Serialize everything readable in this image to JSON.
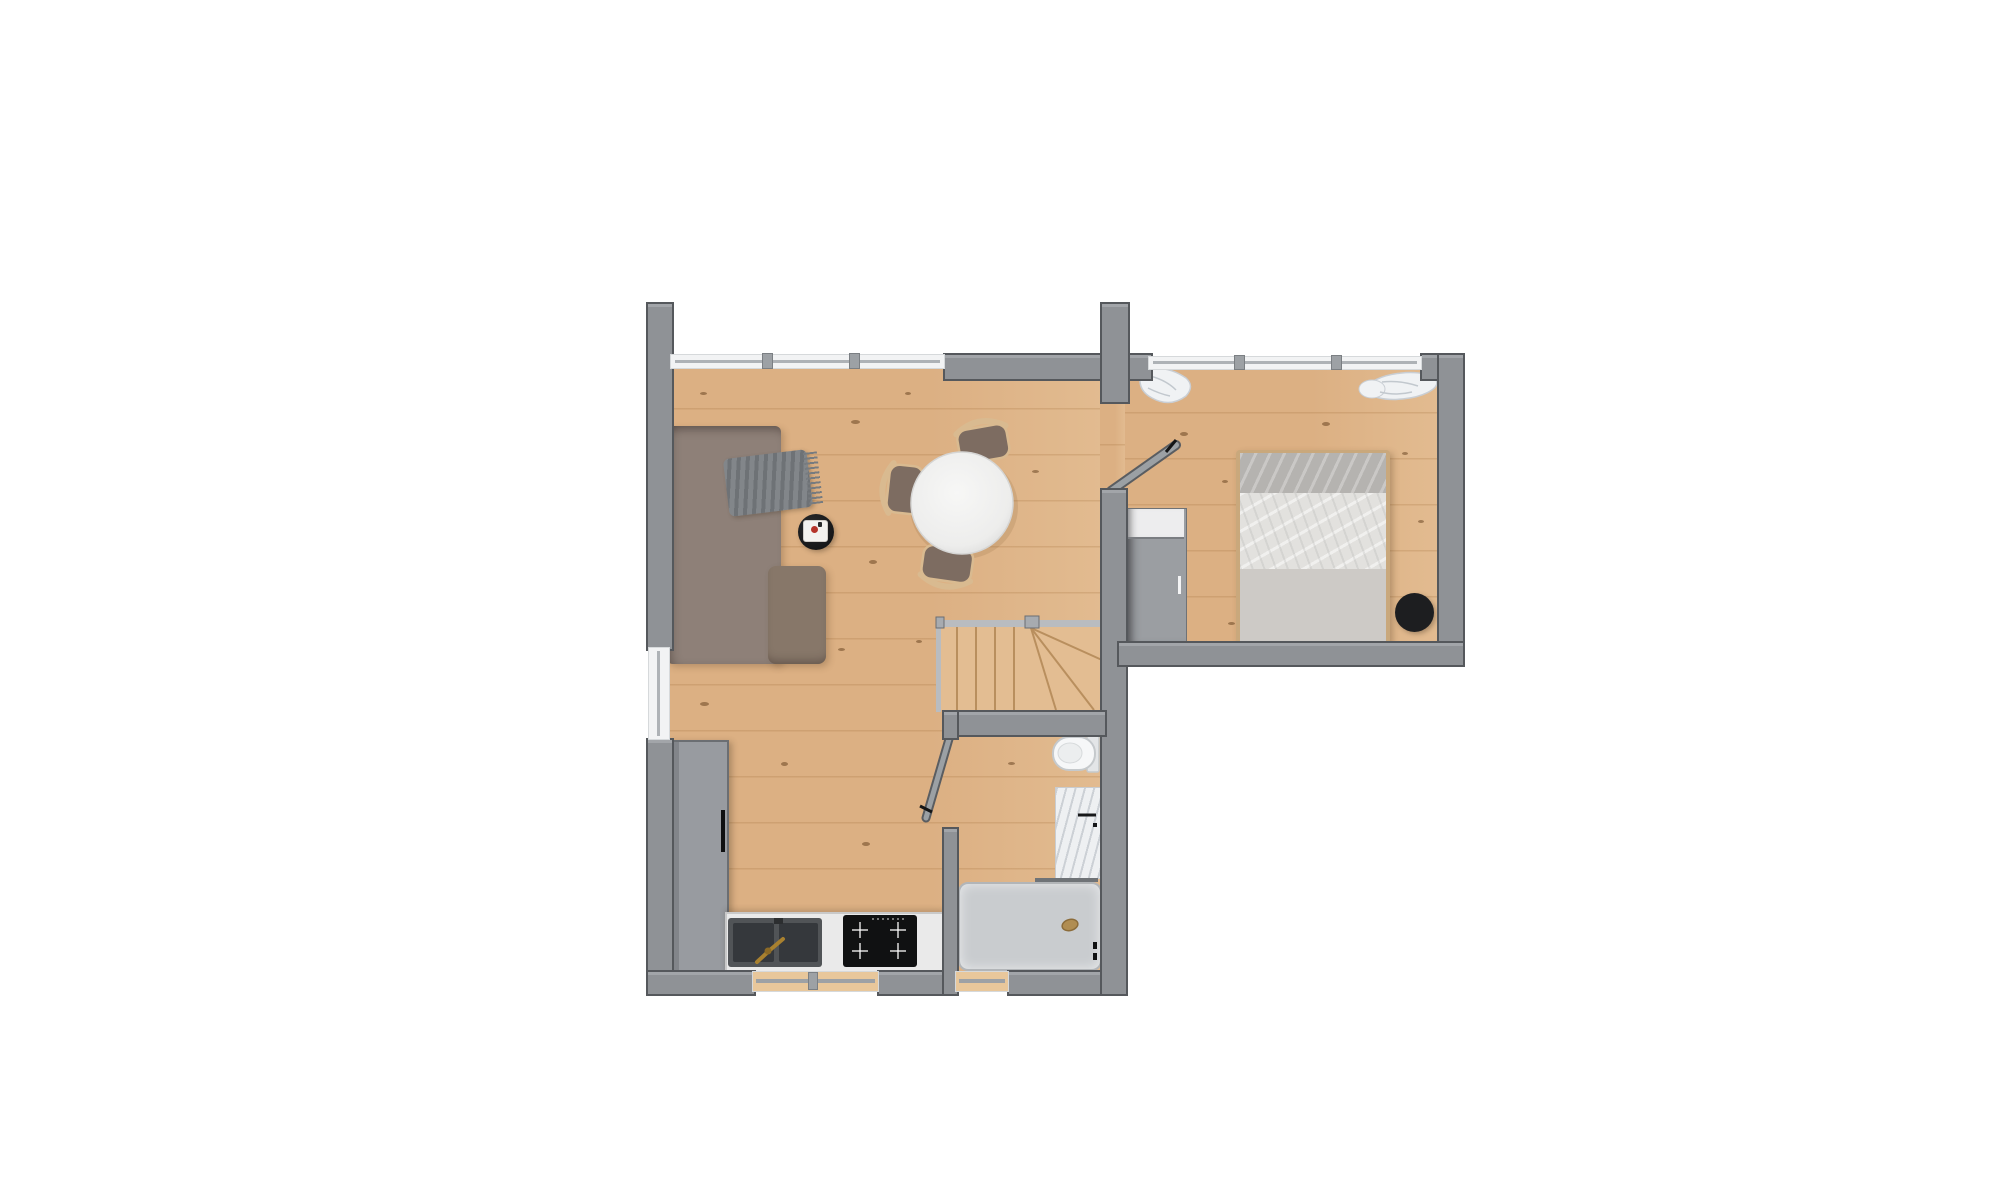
{
  "scene": {
    "kind": "apartment floor plan, top-down 3D render",
    "background": "#ffffff",
    "floor_material": "light oak planks",
    "text_visible": "none"
  },
  "colors": {
    "floor_base": "#dcb083",
    "knot": "rgba(95,60,25,0.5)",
    "wall_fill": "#8f9296",
    "wall_edge": "#55585c",
    "glass": "#aeb2b6",
    "sofa_body": "#8e8078",
    "sofa_chaise": "#877769",
    "pillow": "#f1efeb",
    "throw": "#787c80",
    "table_top": "#f2f2f2",
    "chair_seat": "#7d6c61",
    "chair_wood": "#d9ba90",
    "coffee_black": "#17181a",
    "tray": "#f3f2ef",
    "candle": "#b5342a",
    "cabinet": "#989ba0",
    "counter": "#eaeaea",
    "sink": "#515457",
    "basin": "#35383c",
    "faucet": "#a9812f",
    "cooktop": "#101112",
    "stair_stringer": "#b9bcc0",
    "stair_line": "#b98f5e",
    "fixture_white": "#f6f7f8",
    "marble": "#eef0f2",
    "shower_tray": "#c9cccf",
    "bed_frame": "#c9a87c",
    "bed_band": "#b5b3b0",
    "bed_duvet": "#e2e1de",
    "bed_sheet": "#cdcac6",
    "wardrobe": "#9b9ea2",
    "wardrobe_top": "#ededee",
    "pouf": "#1d1e20",
    "curtain": "#f0f2f4"
  },
  "rooms": [
    {
      "name": "living-dining-area",
      "furniture": [
        "l-shaped-sofa",
        "white-throw-pillows",
        "typographic-print-pillow",
        "gray-fringed-throw",
        "round-black-side-table",
        "white-tray-with-red-candle",
        "round-white-dining-table",
        "dining-chair-top",
        "dining-chair-left",
        "dining-chair-bottom"
      ]
    },
    {
      "name": "kitchen",
      "furniture": [
        "tall-gray-cabinet",
        "white-countertop",
        "double-basin-sink",
        "brass-faucet",
        "induction-cooktop"
      ]
    },
    {
      "name": "staircase",
      "furniture": [
        "straight-treads",
        "winder-treads",
        "stringer",
        "newel-posts"
      ]
    },
    {
      "name": "bathroom",
      "furniture": [
        "wall-hung-toilet",
        "marble-vanity",
        "walk-in-shower",
        "shower-glass-panel",
        "shower-drain"
      ]
    },
    {
      "name": "bedroom",
      "furniture": [
        "double-bed",
        "bed-pillows",
        "wardrobe",
        "black-round-pouf",
        "sheer-curtain-left",
        "sheer-curtain-right"
      ]
    }
  ],
  "openings": {
    "windows": [
      "living-top-window-band",
      "bedroom-top-window-band",
      "left-wall-window",
      "kitchen-bottom-window",
      "shower-bottom-window"
    ],
    "doors": [
      "bedroom-door-open",
      "bathroom-door-open"
    ]
  }
}
